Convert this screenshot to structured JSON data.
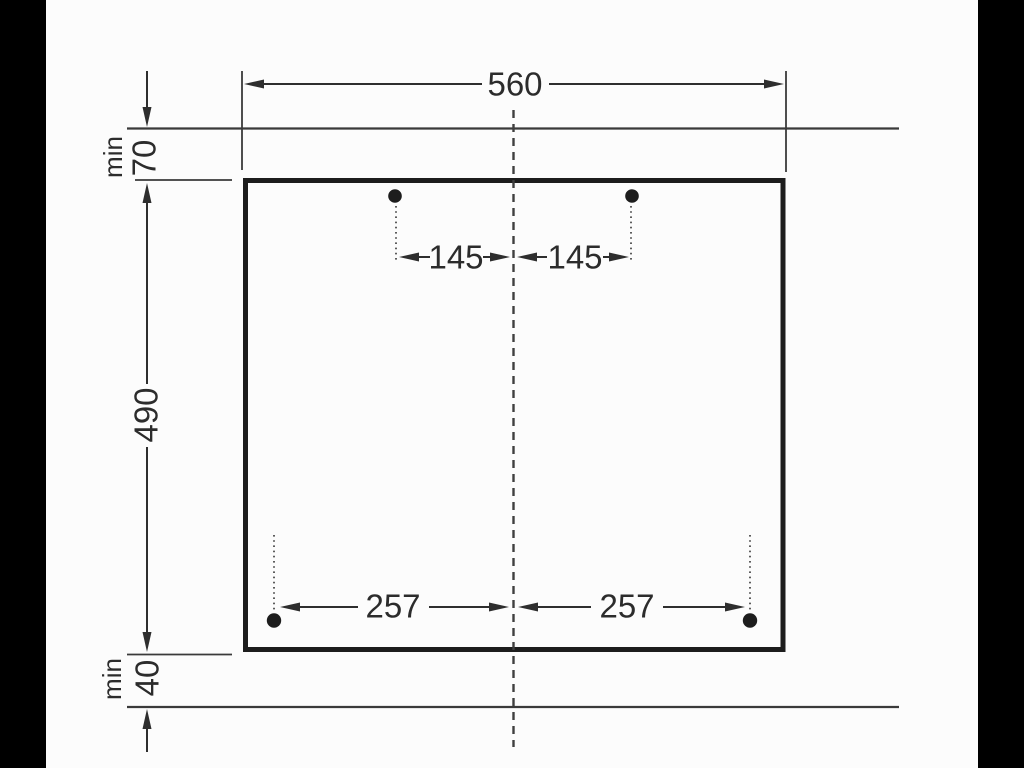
{
  "diagram": {
    "kind": "installation-cutout-dimension-drawing",
    "dimensions": {
      "cutout_width": "560",
      "cutout_height": "490",
      "top_clearance": {
        "prefix": "min",
        "value": "70"
      },
      "bottom_clearance": {
        "prefix": "min",
        "value": "40"
      },
      "top_hole_offset_left": "145",
      "top_hole_offset_right": "145",
      "bottom_hole_offset_left": "257",
      "bottom_hole_offset_right": "257"
    },
    "colors": {
      "background": "#fcfcfc",
      "letterbox": "#000000",
      "thin_line": "#3a3a3a",
      "outline": "#1d1d1d",
      "text": "#2c2c2c"
    }
  }
}
